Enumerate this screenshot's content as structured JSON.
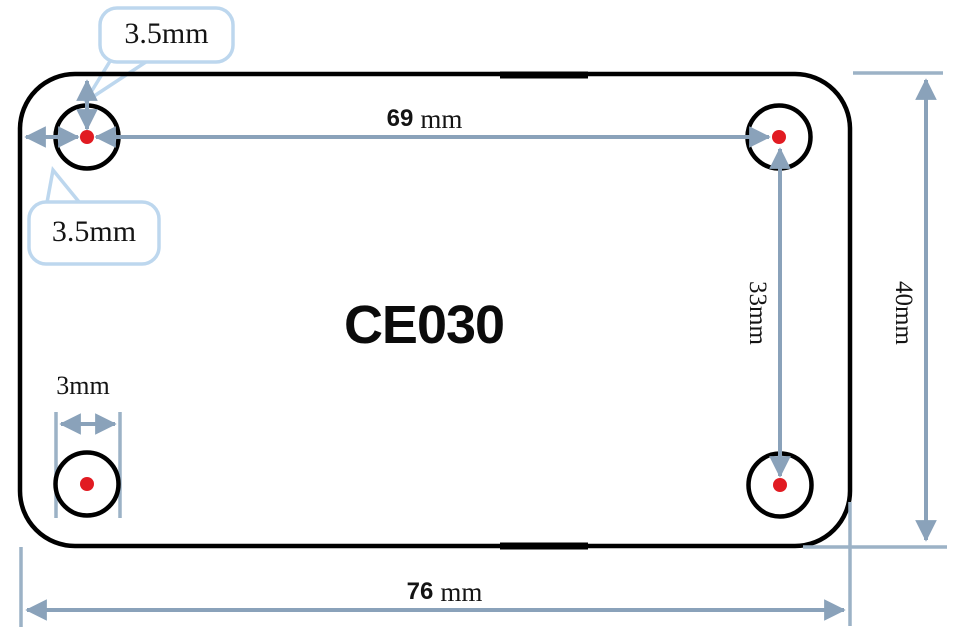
{
  "diagram": {
    "part_label": "CE030",
    "callouts": {
      "top_hole_offset": "3.5mm",
      "left_hole_offset": "3.5mm"
    },
    "dimensions": {
      "hole_pitch_horizontal": {
        "value": "69",
        "unit": "mm"
      },
      "board_width": {
        "value": "76",
        "unit": "mm"
      },
      "hole_pitch_vertical": "33mm",
      "board_height": "40mm",
      "hole_diameter": "3mm"
    },
    "colors": {
      "dimension_line": "#8aa2ba",
      "extension_line": "#9cb2c6",
      "callout_border": "#bdd7ee",
      "board_outline": "#000000",
      "hole_center_dot": "#e11b22",
      "background": "#ffffff"
    }
  }
}
